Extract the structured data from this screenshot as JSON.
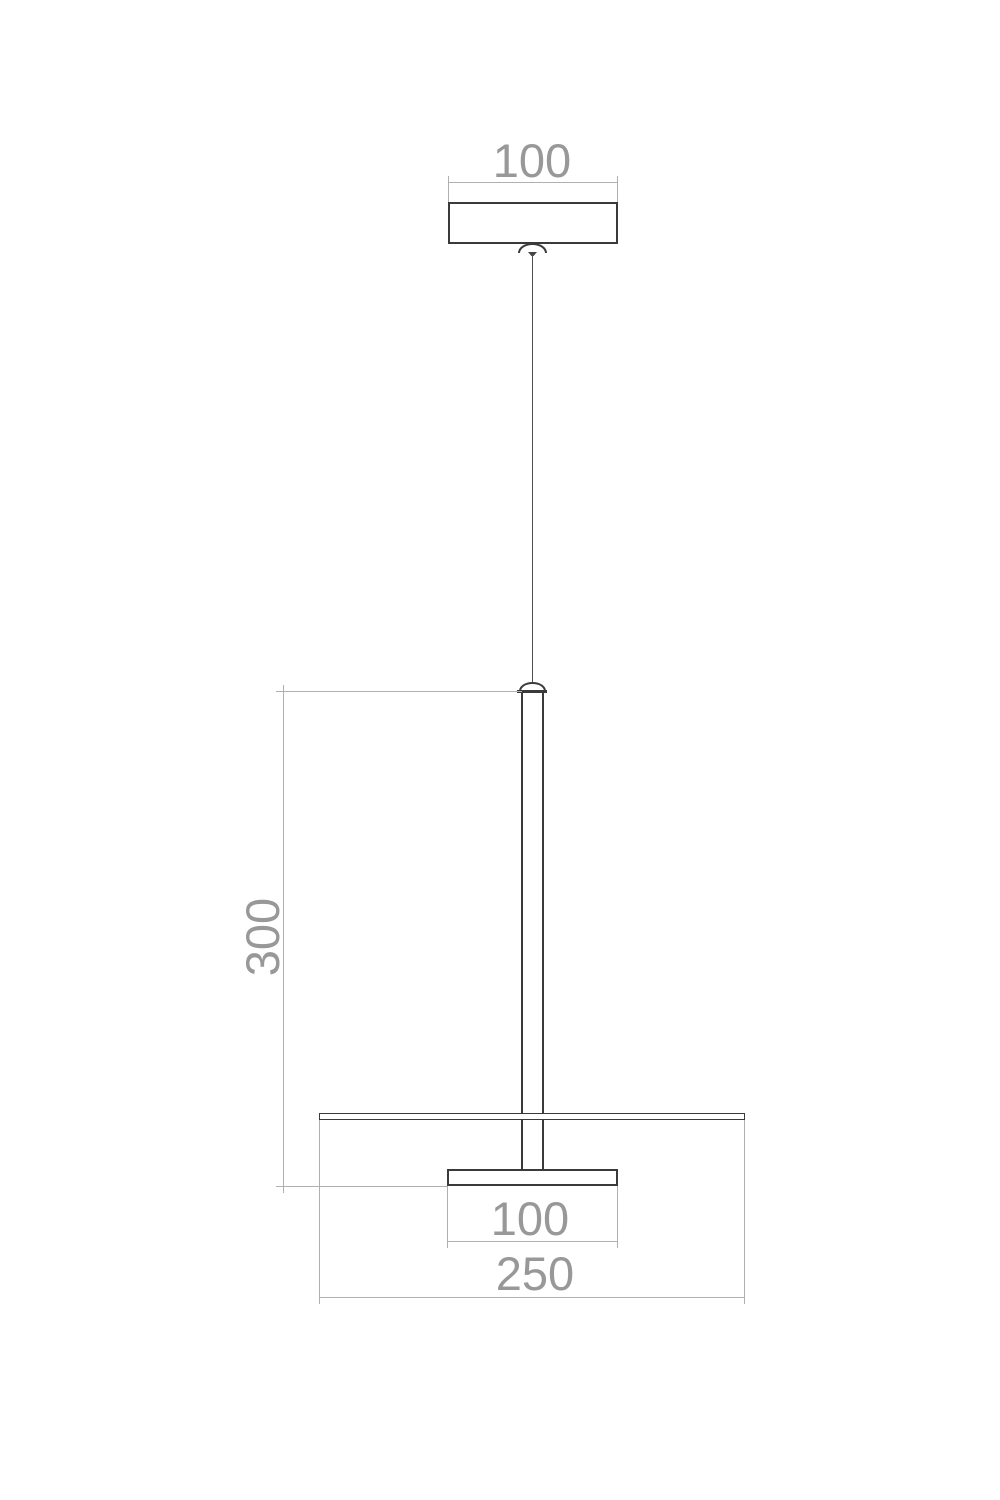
{
  "dims": {
    "canopy_width": "100",
    "rod_height": "300",
    "flange_width": "100",
    "shade_diameter": "250"
  },
  "colors": {
    "object_line": "#3a3a3a",
    "dimension_line": "#b0b0b0",
    "dimension_text": "#989898",
    "background": "#ffffff"
  }
}
